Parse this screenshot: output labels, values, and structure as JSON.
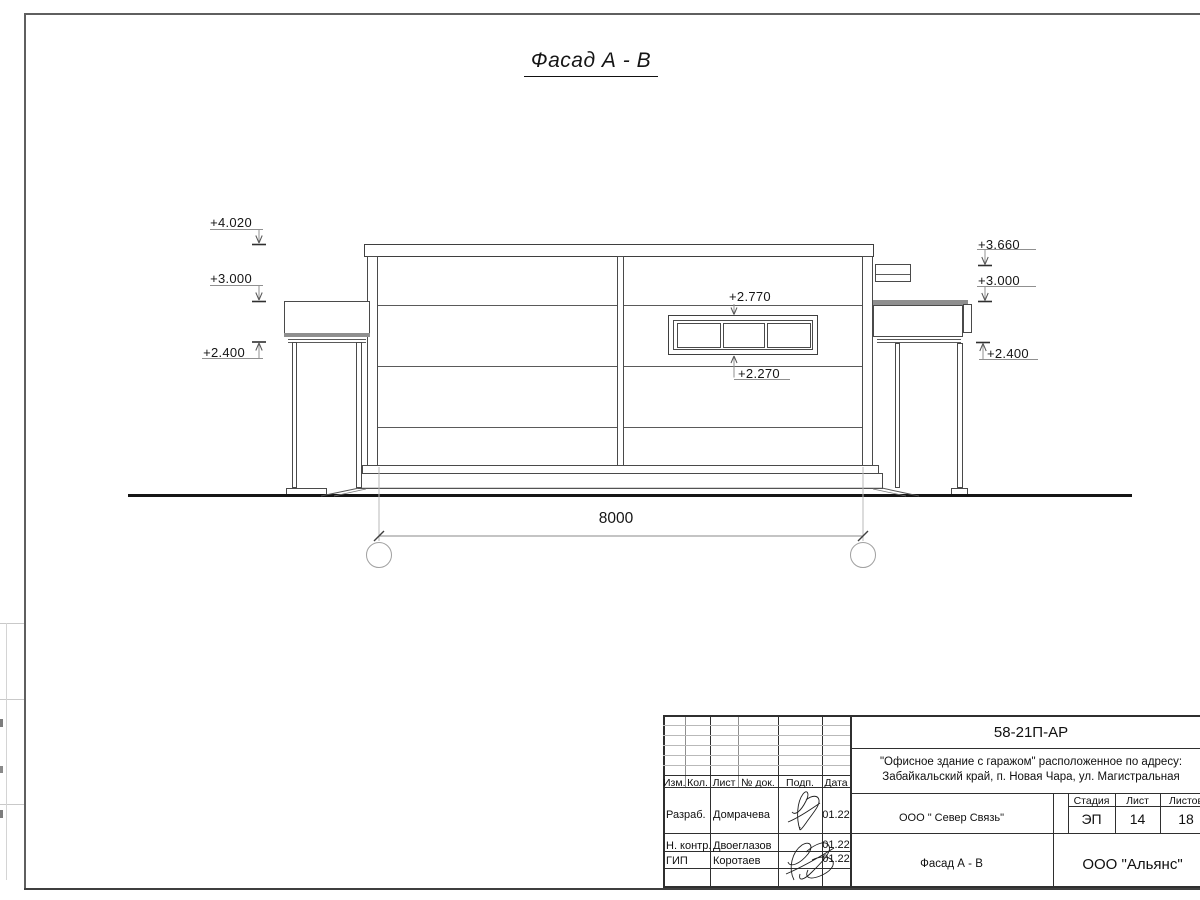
{
  "drawing": {
    "title": "Фасад А - В",
    "dim_8000": "8000",
    "axis_a": "А",
    "axis_b": "В",
    "elev": {
      "l1": "+4.020",
      "l2": "+3.000",
      "l3": "+2.400",
      "r1": "+3.660",
      "r2": "+3.000",
      "r3": "+2.400",
      "win_top": "+2.770",
      "win_bottom": "+2.270"
    }
  },
  "tb": {
    "doc": "58-21П-АР",
    "addr1": "\"Офисное здание с гаражом\" расположенное по адресу:",
    "addr2": "Забайкальский край, п. Новая Чара, ул. Магистральная",
    "org": "ООО \" Север Связь\"",
    "obj": "Фасад А - В",
    "company": "ООО \"Альянс\"",
    "stage_h": "Стадия",
    "list_h": "Лист",
    "listov_h": "Листов",
    "stage_v": "ЭП",
    "list_v": "14",
    "listov_v": "18",
    "cols": [
      "Изм.",
      "Кол.",
      "Лист",
      "№ док.",
      "Подп.",
      "Дата"
    ],
    "rows": [
      {
        "role": "Разраб.",
        "name": "Домрачева",
        "date": "01.22"
      },
      {
        "role": "Н. контр.",
        "name": "Двоеглазов",
        "date": "01.22"
      },
      {
        "role": "ГИП",
        "name": "Коротаев",
        "date": "01.22"
      }
    ]
  }
}
